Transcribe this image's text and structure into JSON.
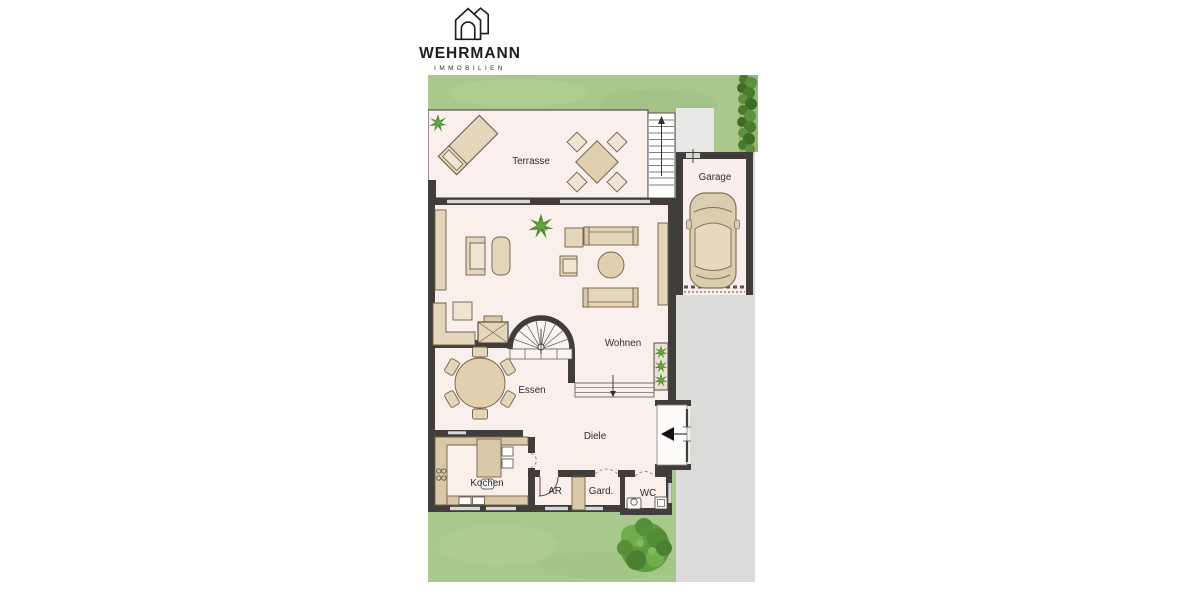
{
  "logo": {
    "brand": "WEHRMANN",
    "subtitle": "IMMOBILIEN"
  },
  "plan": {
    "rooms": [
      {
        "id": "terrasse",
        "label": "Terrasse"
      },
      {
        "id": "garage",
        "label": "Garage"
      },
      {
        "id": "wohnen",
        "label": "Wohnen"
      },
      {
        "id": "essen",
        "label": "Essen"
      },
      {
        "id": "diele",
        "label": "Diele"
      },
      {
        "id": "kochen",
        "label": "Kochen"
      },
      {
        "id": "abstellraum",
        "label": "AR"
      },
      {
        "id": "garderobe",
        "label": "Gard."
      },
      {
        "id": "wc",
        "label": "WC"
      }
    ],
    "colors": {
      "lawn": "#a9c98c",
      "hedge": "#4e7d33",
      "driveway": "#dbdcda",
      "wall": "#403d3b",
      "room_floor": "#f9efeb",
      "furniture": "#e4d6bb",
      "window": "#d8d8d8",
      "tree": "#5f9c40",
      "plant": "#4e8a2e"
    }
  }
}
